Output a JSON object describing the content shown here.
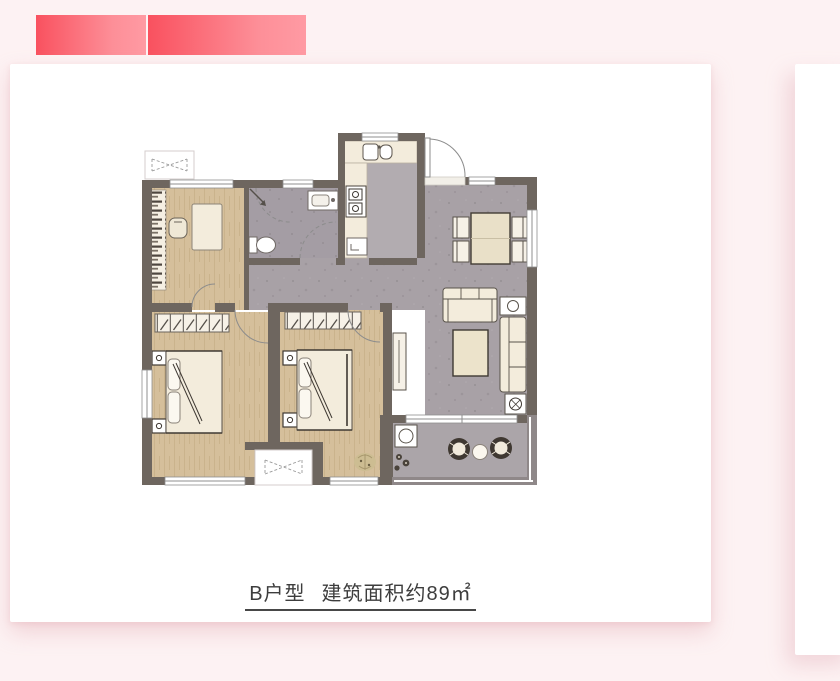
{
  "page": {
    "background": "#fdf2f3"
  },
  "banner": {
    "gradient_start": "#f9515f",
    "gradient_end": "#ff9aa3",
    "block_count": 2
  },
  "carousel": {
    "current_slide": {
      "caption": {
        "unit_type": "B户型",
        "area_text": "建筑面积约89㎡",
        "full": "B户型 建筑面积约89㎡"
      }
    },
    "next_slide": {
      "visible": true
    }
  },
  "floor_plan": {
    "kind": "apartment-floor-plan",
    "rooms": [
      "study",
      "bathroom",
      "kitchen",
      "entry",
      "dining-area",
      "living-room",
      "bedroom-1",
      "bedroom-2",
      "balcony"
    ],
    "palette": {
      "wall": "#6e665f",
      "wood_floor": "#d5bf9b",
      "tile_floor": "#a8a1a6",
      "bath_floor": "#a49da4",
      "kitchen_floor": "#b2acb0",
      "balcony_floor": "#aba5a9",
      "furniture": "#f3ecdc",
      "dark_accent": "#423c35"
    }
  }
}
